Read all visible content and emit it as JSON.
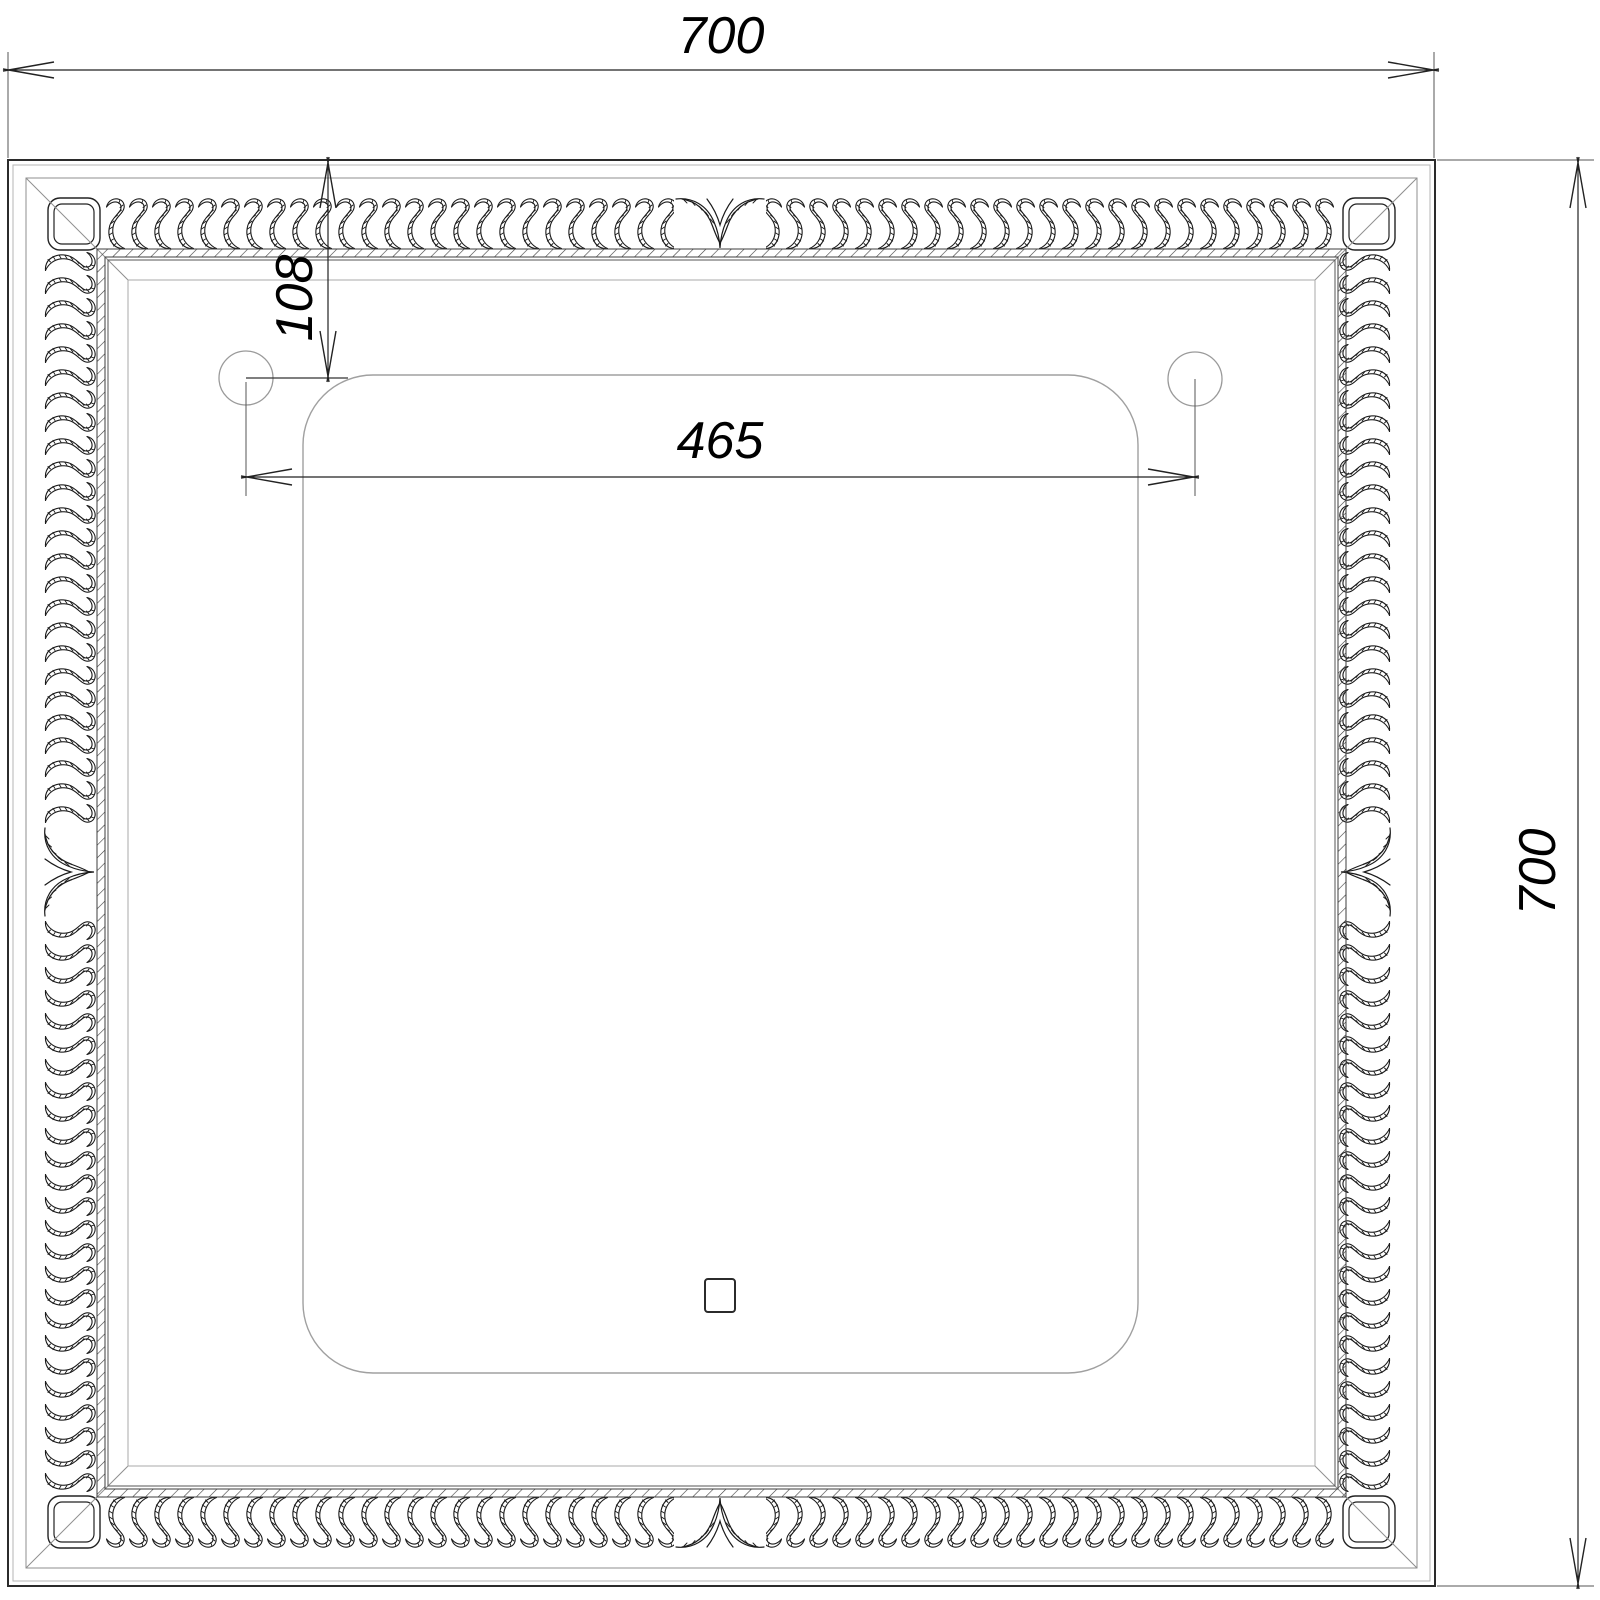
{
  "drawing": {
    "overall_width_label": "700",
    "overall_height_label": "700",
    "hole_spacing_label": "465",
    "hole_top_offset_label": "108"
  },
  "colors": {
    "background": "#ffffff",
    "line": "#1a1a1a",
    "construction_line": "#8f8f8f",
    "dimension_line": "#222222"
  }
}
